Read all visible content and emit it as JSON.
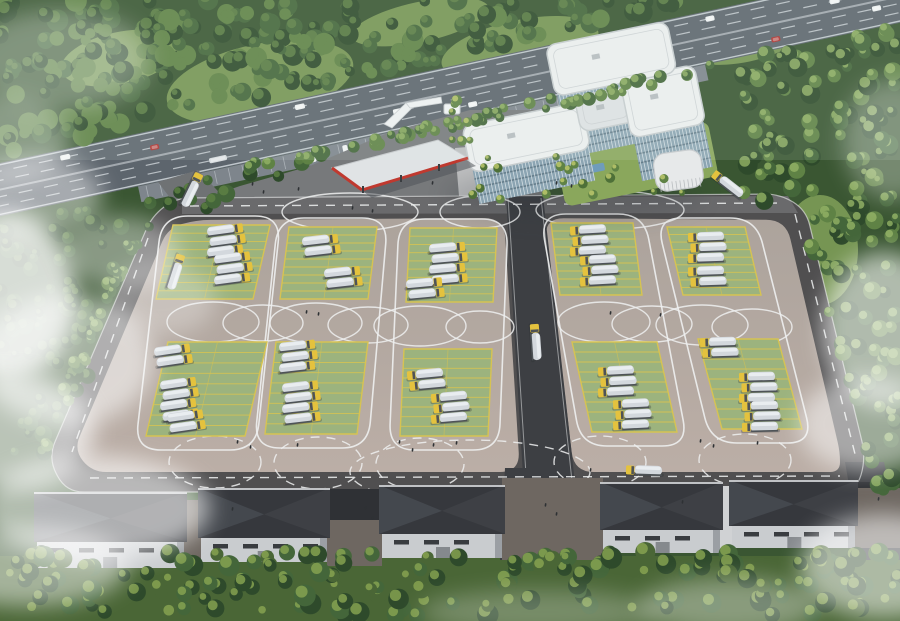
{
  "meta": {
    "description": "Aerial architectural rendering of a truck parking and training facility: highway at top, white office building, red-trim canopy, striped truck parking lot with loop lane markings, warehouses at bottom, forest and fog at the edges"
  },
  "palette": {
    "forestBase": "#3a5632",
    "forestTreeDark": "#2e4a2b",
    "forestTree": "#44663a",
    "forestTreeLight": "#5f8245",
    "grassClear": "#7d9c57",
    "grassBright": "#93b365",
    "highwayRoad": "#5d656d",
    "laneWhite": "#d8dee2",
    "frontage": "#7e858c",
    "plaza": "#77797b",
    "driveway": "#6f7274",
    "lotEdgeRoad": "#504f50",
    "topRoad": "#6a6a6c",
    "lotPaveTop": "#aca39c",
    "lotPaveBot": "#bbaea6",
    "centerRoad": "#3d3f43",
    "padGreen": "#9cb37e",
    "padLine": "#d6c352",
    "mark": "#eef0f0",
    "truckTank": "#d3d8dd",
    "truckTankTop": "#e9edf0",
    "truckCab": "#e4c23e",
    "truckDark": "#4e5357",
    "bldgWhite": "#edeff0",
    "bldgRoofLow": "#dfe2e4",
    "bldgRoofEdge": "#c7ccce",
    "glass": "#8ba4b2",
    "glassDark": "#566e7c",
    "fin": "#eaf0f2",
    "canopyTop": "#e0e3e5",
    "canopyRed": "#c0392f",
    "canopyShadow": "#50535a",
    "pavilion": "#e7e9ea",
    "whRoof": "#36383d",
    "whRoofHip": "#4a4e54",
    "whWall": "#c9cccf",
    "whWallShade": "#9b9fa4",
    "whWin": "#393c40",
    "gapBrick": "#6e6761",
    "gapDark": "#2f3135",
    "ramp": "#d0d2d4",
    "treeBandBase": "#4a6636",
    "treeHi": "#8aa653",
    "treeYellow": "#b6c169",
    "lawn": "#8aa75c",
    "lawnTree": "#4e7038",
    "lawnTreeHi": "#c2cc6e",
    "pool": "#6f9cba",
    "people": "#2e3134",
    "carWhite": "#f1f3f4",
    "carRed": "#ae3330",
    "carDark": "#3e444a",
    "bus": "#d9dde0"
  },
  "highway": {
    "y0": 163,
    "slope": -0.215,
    "width": 52,
    "lanes": [
      8,
      17,
      33,
      42
    ],
    "vehicles": [
      {
        "x": 60,
        "lane": 0,
        "c": "carWhite",
        "l": 10
      },
      {
        "x": 150,
        "lane": 1,
        "c": "carRed",
        "l": 9
      },
      {
        "x": 205,
        "lane": 3,
        "c": "bus",
        "l": 18
      },
      {
        "x": 300,
        "lane": 0,
        "c": "carWhite",
        "l": 10
      },
      {
        "x": 395,
        "lane": 2,
        "c": "carWhite",
        "l": 10
      },
      {
        "x": 470,
        "lane": 3,
        "c": "carWhite",
        "l": 9
      },
      {
        "x": 560,
        "lane": 1,
        "c": "carDark",
        "l": 10
      },
      {
        "x": 640,
        "lane": 2,
        "c": "bus",
        "l": 16
      },
      {
        "x": 720,
        "lane": 0,
        "c": "carWhite",
        "l": 9
      },
      {
        "x": 780,
        "lane": 3,
        "c": "carRed",
        "l": 9
      },
      {
        "x": 845,
        "lane": 1,
        "c": "carWhite",
        "l": 10
      },
      {
        "x": 885,
        "lane": 2,
        "c": "carWhite",
        "l": 9
      }
    ],
    "frontage": {
      "x": 130,
      "w": 580,
      "h": 16
    },
    "parked": [
      {
        "x": 290
      },
      {
        "x": 305
      },
      {
        "x": 338
      },
      {
        "x": 372
      },
      {
        "x": 430
      },
      {
        "x": 447
      }
    ]
  },
  "plaza": [
    [
      148,
      242
    ],
    [
      176,
      208
    ],
    [
      240,
      186
    ],
    [
      310,
      166
    ],
    [
      390,
      132
    ],
    [
      470,
      110
    ],
    [
      543,
      110
    ],
    [
      550,
      202
    ],
    [
      500,
      206
    ],
    [
      182,
      216
    ]
  ],
  "driveway": [
    [
      158,
      182
    ],
    [
      198,
      170
    ],
    [
      232,
      206
    ],
    [
      190,
      224
    ]
  ],
  "walkway": [
    [
      455,
      148
    ],
    [
      480,
      146
    ],
    [
      486,
      206
    ],
    [
      460,
      208
    ]
  ],
  "lot": {
    "outer": [
      [
        176,
        198
      ],
      [
        780,
        194
      ],
      [
        806,
        210
      ],
      [
        866,
        458
      ],
      [
        856,
        492
      ],
      [
        66,
        492
      ],
      [
        48,
        458
      ],
      [
        152,
        216
      ]
    ],
    "innerLeft": [
      [
        196,
        220
      ],
      [
        504,
        218
      ],
      [
        520,
        472
      ],
      [
        92,
        472
      ],
      [
        74,
        450
      ],
      [
        168,
        228
      ]
    ],
    "innerRight": [
      [
        544,
        218
      ],
      [
        786,
        220
      ],
      [
        840,
        452
      ],
      [
        840,
        472
      ],
      [
        574,
        472
      ]
    ],
    "centerRoad": [
      [
        506,
        196
      ],
      [
        543,
        196
      ],
      [
        576,
        492
      ],
      [
        524,
        492
      ]
    ],
    "topRoadStrip": [
      [
        182,
        198
      ],
      [
        788,
        196
      ],
      [
        798,
        213
      ],
      [
        182,
        214
      ]
    ]
  },
  "exit_roads": [
    {
      "pts": [
        [
          505,
          468
        ],
        [
          556,
          468
        ],
        [
          548,
          560
        ],
        [
          500,
          560
        ]
      ]
    },
    {
      "pts": [
        [
          845,
          462
        ],
        [
          884,
          462
        ],
        [
          906,
          560
        ],
        [
          862,
          560
        ]
      ]
    }
  ],
  "pads": [
    {
      "tx": 173,
      "ty": 225,
      "bx": 156,
      "by": 299,
      "w": 97
    },
    {
      "tx": 289,
      "ty": 227,
      "bx": 280,
      "by": 299,
      "w": 88
    },
    {
      "tx": 410,
      "ty": 228,
      "bx": 406,
      "by": 302,
      "w": 87
    },
    {
      "tx": 551,
      "ty": 223,
      "bx": 560,
      "by": 295,
      "w": 82
    },
    {
      "tx": 667,
      "ty": 227,
      "bx": 683,
      "by": 295,
      "w": 78
    },
    {
      "tx": 168,
      "ty": 342,
      "bx": 146,
      "by": 436,
      "w": 99
    },
    {
      "tx": 276,
      "ty": 342,
      "bx": 265,
      "by": 434,
      "w": 92
    },
    {
      "tx": 404,
      "ty": 349,
      "bx": 400,
      "by": 436,
      "w": 88
    },
    {
      "tx": 572,
      "ty": 342,
      "bx": 592,
      "by": 432,
      "w": 85
    },
    {
      "tx": 698,
      "ty": 339,
      "bx": 722,
      "by": 429,
      "w": 80
    }
  ],
  "stalls_per_pad": 9,
  "loop_columns": [
    [
      0,
      5
    ],
    [
      1,
      6
    ],
    [
      2,
      7
    ],
    [
      3,
      8
    ],
    [
      4,
      9
    ]
  ],
  "circle_marks": [
    {
      "cx": 213,
      "cy": 322,
      "rx": 46,
      "ry": 20
    },
    {
      "cx": 263,
      "cy": 323,
      "rx": 40,
      "ry": 18
    },
    {
      "cx": 316,
      "cy": 323,
      "rx": 46,
      "ry": 20
    },
    {
      "cx": 368,
      "cy": 325,
      "rx": 40,
      "ry": 18
    },
    {
      "cx": 420,
      "cy": 326,
      "rx": 46,
      "ry": 20
    },
    {
      "cx": 480,
      "cy": 327,
      "rx": 34,
      "ry": 16
    },
    {
      "cx": 604,
      "cy": 322,
      "rx": 46,
      "ry": 20
    },
    {
      "cx": 652,
      "cy": 324,
      "rx": 40,
      "ry": 18
    },
    {
      "cx": 702,
      "cy": 325,
      "rx": 46,
      "ry": 20
    },
    {
      "cx": 752,
      "cy": 327,
      "rx": 40,
      "ry": 18
    }
  ],
  "top_arcs": [
    {
      "cx": 350,
      "cy": 212,
      "rx": 68,
      "ry": 19
    },
    {
      "cx": 610,
      "cy": 210,
      "rx": 74,
      "ry": 19
    },
    {
      "cx": 480,
      "cy": 212,
      "rx": 40,
      "ry": 16
    }
  ],
  "bottom_arcs": [
    {
      "cx": 215,
      "cy": 462,
      "rx": 46,
      "ry": 26
    },
    {
      "cx": 318,
      "cy": 463,
      "rx": 44,
      "ry": 26
    },
    {
      "cx": 420,
      "cy": 464,
      "rx": 44,
      "ry": 26
    },
    {
      "cx": 600,
      "cy": 462,
      "rx": 46,
      "ry": 26
    },
    {
      "cx": 745,
      "cy": 460,
      "rx": 46,
      "ry": 26
    },
    {
      "cx": 470,
      "cy": 472,
      "rx": 120,
      "ry": 32
    }
  ],
  "dash_lines": [
    [
      190,
      206,
      780,
      203
    ],
    [
      148,
      238,
      72,
      452
    ],
    [
      795,
      214,
      856,
      458
    ],
    [
      90,
      478,
      840,
      476
    ]
  ],
  "truck_groups": [
    {
      "x": 225,
      "y": 240,
      "n": 3,
      "cab": "R"
    },
    {
      "x": 232,
      "y": 268,
      "n": 3,
      "cab": "R"
    },
    {
      "x": 320,
      "y": 245,
      "n": 2,
      "cab": "R"
    },
    {
      "x": 342,
      "y": 277,
      "n": 2,
      "cab": "R"
    },
    {
      "x": 447,
      "y": 263,
      "n": 4,
      "cab": "R"
    },
    {
      "x": 424,
      "y": 288,
      "n": 2,
      "cab": "R"
    },
    {
      "x": 588,
      "y": 240,
      "n": 3,
      "cab": "L"
    },
    {
      "x": 598,
      "y": 270,
      "n": 3,
      "cab": "L"
    },
    {
      "x": 706,
      "y": 247,
      "n": 3,
      "cab": "L"
    },
    {
      "x": 706,
      "y": 276,
      "n": 2,
      "cab": "L"
    },
    {
      "x": 172,
      "y": 355,
      "n": 2,
      "cab": "R"
    },
    {
      "x": 178,
      "y": 399,
      "n": 4,
      "cab": "R"
    },
    {
      "x": 185,
      "y": 421,
      "n": 2,
      "cab": "R"
    },
    {
      "x": 297,
      "y": 356,
      "n": 3,
      "cab": "R"
    },
    {
      "x": 300,
      "y": 402,
      "n": 4,
      "cab": "R"
    },
    {
      "x": 425,
      "y": 379,
      "n": 2,
      "cab": "L"
    },
    {
      "x": 449,
      "y": 407,
      "n": 3,
      "cab": "L"
    },
    {
      "x": 616,
      "y": 381,
      "n": 3,
      "cab": "L"
    },
    {
      "x": 631,
      "y": 414,
      "n": 3,
      "cab": "L"
    },
    {
      "x": 718,
      "y": 347,
      "n": 2,
      "cab": "L"
    },
    {
      "x": 757,
      "y": 387,
      "n": 3,
      "cab": "L"
    },
    {
      "x": 760,
      "y": 416,
      "n": 3,
      "cab": "L"
    }
  ],
  "road_trucks": [
    {
      "x": 176,
      "y": 272,
      "rot": 108
    },
    {
      "x": 536,
      "y": 342,
      "rot": 86
    },
    {
      "x": 644,
      "y": 470,
      "rot": 2
    },
    {
      "x": 192,
      "y": 190,
      "rot": 116
    },
    {
      "x": 728,
      "y": 184,
      "rot": 38
    }
  ],
  "people": [
    [
      252,
      182
    ],
    [
      263,
      190
    ],
    [
      298,
      187
    ],
    [
      306,
      310
    ],
    [
      318,
      312
    ],
    [
      610,
      311
    ],
    [
      660,
      313
    ],
    [
      237,
      440
    ],
    [
      250,
      445
    ],
    [
      297,
      443
    ],
    [
      399,
      440
    ],
    [
      412,
      448
    ],
    [
      433,
      443
    ],
    [
      456,
      441
    ],
    [
      700,
      439
    ],
    [
      713,
      444
    ],
    [
      757,
      441
    ],
    [
      365,
      506
    ],
    [
      372,
      516
    ],
    [
      545,
      503
    ],
    [
      556,
      512
    ],
    [
      232,
      507
    ],
    [
      682,
      500
    ],
    [
      590,
      468
    ],
    [
      352,
      206
    ],
    [
      372,
      209
    ],
    [
      432,
      181
    ],
    [
      556,
      181
    ],
    [
      571,
      184
    ],
    [
      878,
      497
    ]
  ],
  "building": {
    "tx": 462,
    "ty": 128,
    "rot": -11.5,
    "lawn": {
      "x": 86,
      "y": 42,
      "w": 156,
      "h": 56
    },
    "pool": {
      "x": 104,
      "y": 62,
      "w": 28,
      "h": 8
    },
    "roofs": [
      {
        "x": 0,
        "y": -2,
        "w": 122,
        "h": 48,
        "low": false
      },
      {
        "x": 116,
        "y": -8,
        "w": 56,
        "h": 36,
        "low": true
      },
      {
        "x": 164,
        "y": -16,
        "w": 76,
        "h": 60,
        "low": false
      },
      {
        "x": 98,
        "y": -64,
        "w": 124,
        "h": 52,
        "low": false
      }
    ],
    "facades": [
      {
        "x": 2,
        "y": 44,
        "w": 118,
        "h": 34,
        "floors": 4
      },
      {
        "x": 118,
        "y": 26,
        "w": 52,
        "h": 24,
        "floors": 3
      },
      {
        "x": 166,
        "y": 42,
        "w": 72,
        "h": 46,
        "floors": 5
      },
      {
        "x": 100,
        "y": -13,
        "w": 64,
        "h": 12,
        "floors": 1
      }
    ]
  },
  "canopy": {
    "quad": [
      [
        332,
        168
      ],
      [
        438,
        140
      ],
      [
        468,
        158
      ],
      [
        362,
        190
      ]
    ],
    "shadow": [
      [
        342,
        176
      ],
      [
        448,
        148
      ],
      [
        476,
        166
      ],
      [
        372,
        198
      ]
    ],
    "red_edges": [
      [
        [
          332,
          168
        ],
        [
          362,
          190
        ]
      ],
      [
        [
          362,
          190
        ],
        [
          468,
          158
        ]
      ]
    ],
    "cols": [
      [
        362,
        186
      ],
      [
        400,
        175
      ],
      [
        438,
        164
      ]
    ]
  },
  "gate": {
    "polys": [
      [
        [
          384,
          124
        ],
        [
          406,
          103
        ],
        [
          413,
          107
        ],
        [
          392,
          128
        ]
      ],
      [
        [
          406,
          103
        ],
        [
          441,
          97
        ],
        [
          442,
          103
        ],
        [
          410,
          108
        ]
      ]
    ]
  },
  "tent": {
    "x": 444,
    "y": 104,
    "w": 16,
    "h": 10
  },
  "pavilion": {
    "x": 652,
    "y": 155,
    "w": 48,
    "h": 38
  },
  "warehouses": [
    {
      "x": 37,
      "roofY": 492,
      "wallY": 540,
      "wallH": 28,
      "w": 147
    },
    {
      "x": 201,
      "roofY": 488,
      "wallY": 536,
      "wallH": 26,
      "w": 126
    },
    {
      "x": 382,
      "roofY": 485,
      "wallY": 532,
      "wallH": 26,
      "w": 120
    },
    {
      "x": 603,
      "roofY": 482,
      "wallY": 528,
      "wallH": 25,
      "w": 117
    },
    {
      "x": 732,
      "roofY": 480,
      "wallY": 524,
      "wallH": 24,
      "w": 123
    }
  ],
  "gaps": [
    {
      "x": 184,
      "y": 500,
      "w": 17,
      "h": 66,
      "fill": "gapBrick"
    },
    {
      "x": 327,
      "y": 520,
      "w": 55,
      "h": 46,
      "fill": "gapBrick"
    },
    {
      "x": 502,
      "y": 478,
      "w": 101,
      "h": 82,
      "fill": "gapBrick"
    },
    {
      "x": 720,
      "y": 486,
      "w": 12,
      "h": 64,
      "fill": "ramp"
    },
    {
      "x": 855,
      "y": 488,
      "w": 45,
      "h": 60,
      "fill": "gapBrick"
    }
  ],
  "sheds": [
    {
      "x": 330,
      "y": 489,
      "w": 50,
      "h": 42,
      "fill": "gapDark"
    },
    {
      "x": 560,
      "y": 484,
      "w": 42,
      "h": 42,
      "fill": "gapDark"
    },
    {
      "x": 858,
      "y": 482,
      "w": 30,
      "h": 36,
      "fill": "gapDark"
    }
  ],
  "clearings": [
    {
      "x": 260,
      "y": 82,
      "rx": 95,
      "ry": 38,
      "rot": -12
    },
    {
      "x": 520,
      "y": 48,
      "rx": 80,
      "ry": 28,
      "rot": -12
    },
    {
      "x": 120,
      "y": 58,
      "rx": 60,
      "ry": 26,
      "rot": -12
    },
    {
      "x": 745,
      "y": 40,
      "rx": 60,
      "ry": 22,
      "rot": -12
    },
    {
      "x": 820,
      "y": 250,
      "rx": 38,
      "ry": 55,
      "rot": 0
    },
    {
      "x": 800,
      "y": 420,
      "rx": 48,
      "ry": 28,
      "rot": 0
    },
    {
      "x": 420,
      "y": 22,
      "rx": 70,
      "ry": 20,
      "rot": -12
    }
  ],
  "tree_regions": [
    {
      "name": "top-forest",
      "count": 240,
      "rmin": 5,
      "rmax": 11,
      "seed": 11,
      "cols": [
        "forestTreeDark",
        "forestTree",
        "forestTreeLight"
      ],
      "hi": "forestTreeLight"
    },
    {
      "name": "below-left",
      "count": 95,
      "rmin": 4,
      "rmax": 9,
      "seed": 22,
      "cols": [
        "forestTreeDark",
        "forestTree"
      ],
      "hi": "forestTreeLight"
    },
    {
      "name": "tree-line",
      "count": 60,
      "rmin": 4,
      "rmax": 7,
      "seed": 33,
      "cols": [
        "forestTree",
        "forestTreeLight"
      ],
      "hi": "grassBright"
    },
    {
      "name": "right-forest",
      "count": 150,
      "rmin": 5,
      "rmax": 10,
      "seed": 44,
      "cols": [
        "forestTreeDark",
        "forestTree",
        "forestTreeLight"
      ],
      "hi": "grassBright"
    },
    {
      "name": "bottom-band",
      "count": 170,
      "rmin": 6,
      "rmax": 11,
      "seed": 55,
      "cols": [
        "treeBandBase",
        "forestTreeDark",
        "forestTree"
      ],
      "hi": "treeHi"
    },
    {
      "name": "left-road",
      "count": 26,
      "rmin": 4,
      "rmax": 7,
      "seed": 66,
      "cols": [
        "forestTree",
        "forestTreeLight"
      ],
      "hi": "grassBright"
    },
    {
      "name": "lawn",
      "count": 26,
      "rmin": 3,
      "rmax": 6,
      "seed": 77,
      "cols": [
        "lawnTree",
        "forestTreeLight"
      ],
      "hi": "lawnTreeHi"
    }
  ],
  "fog": [
    {
      "x": 6,
      "y": 296,
      "rx": 70,
      "ry": 85,
      "o": 0.8
    },
    {
      "x": 66,
      "y": 360,
      "rx": 88,
      "ry": 66,
      "o": 0.55
    },
    {
      "x": 12,
      "y": 432,
      "rx": 82,
      "ry": 58,
      "o": 0.65
    },
    {
      "x": 95,
      "y": 508,
      "rx": 115,
      "ry": 52,
      "o": 0.6
    },
    {
      "x": 28,
      "y": 566,
      "rx": 100,
      "ry": 40,
      "o": 0.5
    },
    {
      "x": 160,
      "y": 300,
      "rx": 56,
      "ry": 36,
      "o": 0.3
    },
    {
      "x": 884,
      "y": 330,
      "rx": 62,
      "ry": 78,
      "o": 0.6
    },
    {
      "x": 868,
      "y": 424,
      "rx": 70,
      "ry": 48,
      "o": 0.5
    },
    {
      "x": 884,
      "y": 566,
      "rx": 84,
      "ry": 52,
      "o": 0.55
    },
    {
      "x": 730,
      "y": 606,
      "rx": 90,
      "ry": 28,
      "o": 0.35
    },
    {
      "x": 36,
      "y": 196,
      "rx": 66,
      "ry": 40,
      "o": 0.45
    },
    {
      "x": 120,
      "y": 252,
      "rx": 60,
      "ry": 36,
      "o": 0.4
    },
    {
      "x": 60,
      "y": 60,
      "rx": 90,
      "ry": 50,
      "o": 0.3
    },
    {
      "x": 0,
      "y": 140,
      "rx": 70,
      "ry": 44,
      "o": 0.35
    },
    {
      "x": 893,
      "y": 140,
      "rx": 50,
      "ry": 60,
      "o": 0.3
    },
    {
      "x": 540,
      "y": 612,
      "rx": 120,
      "ry": 22,
      "o": 0.25
    }
  ]
}
